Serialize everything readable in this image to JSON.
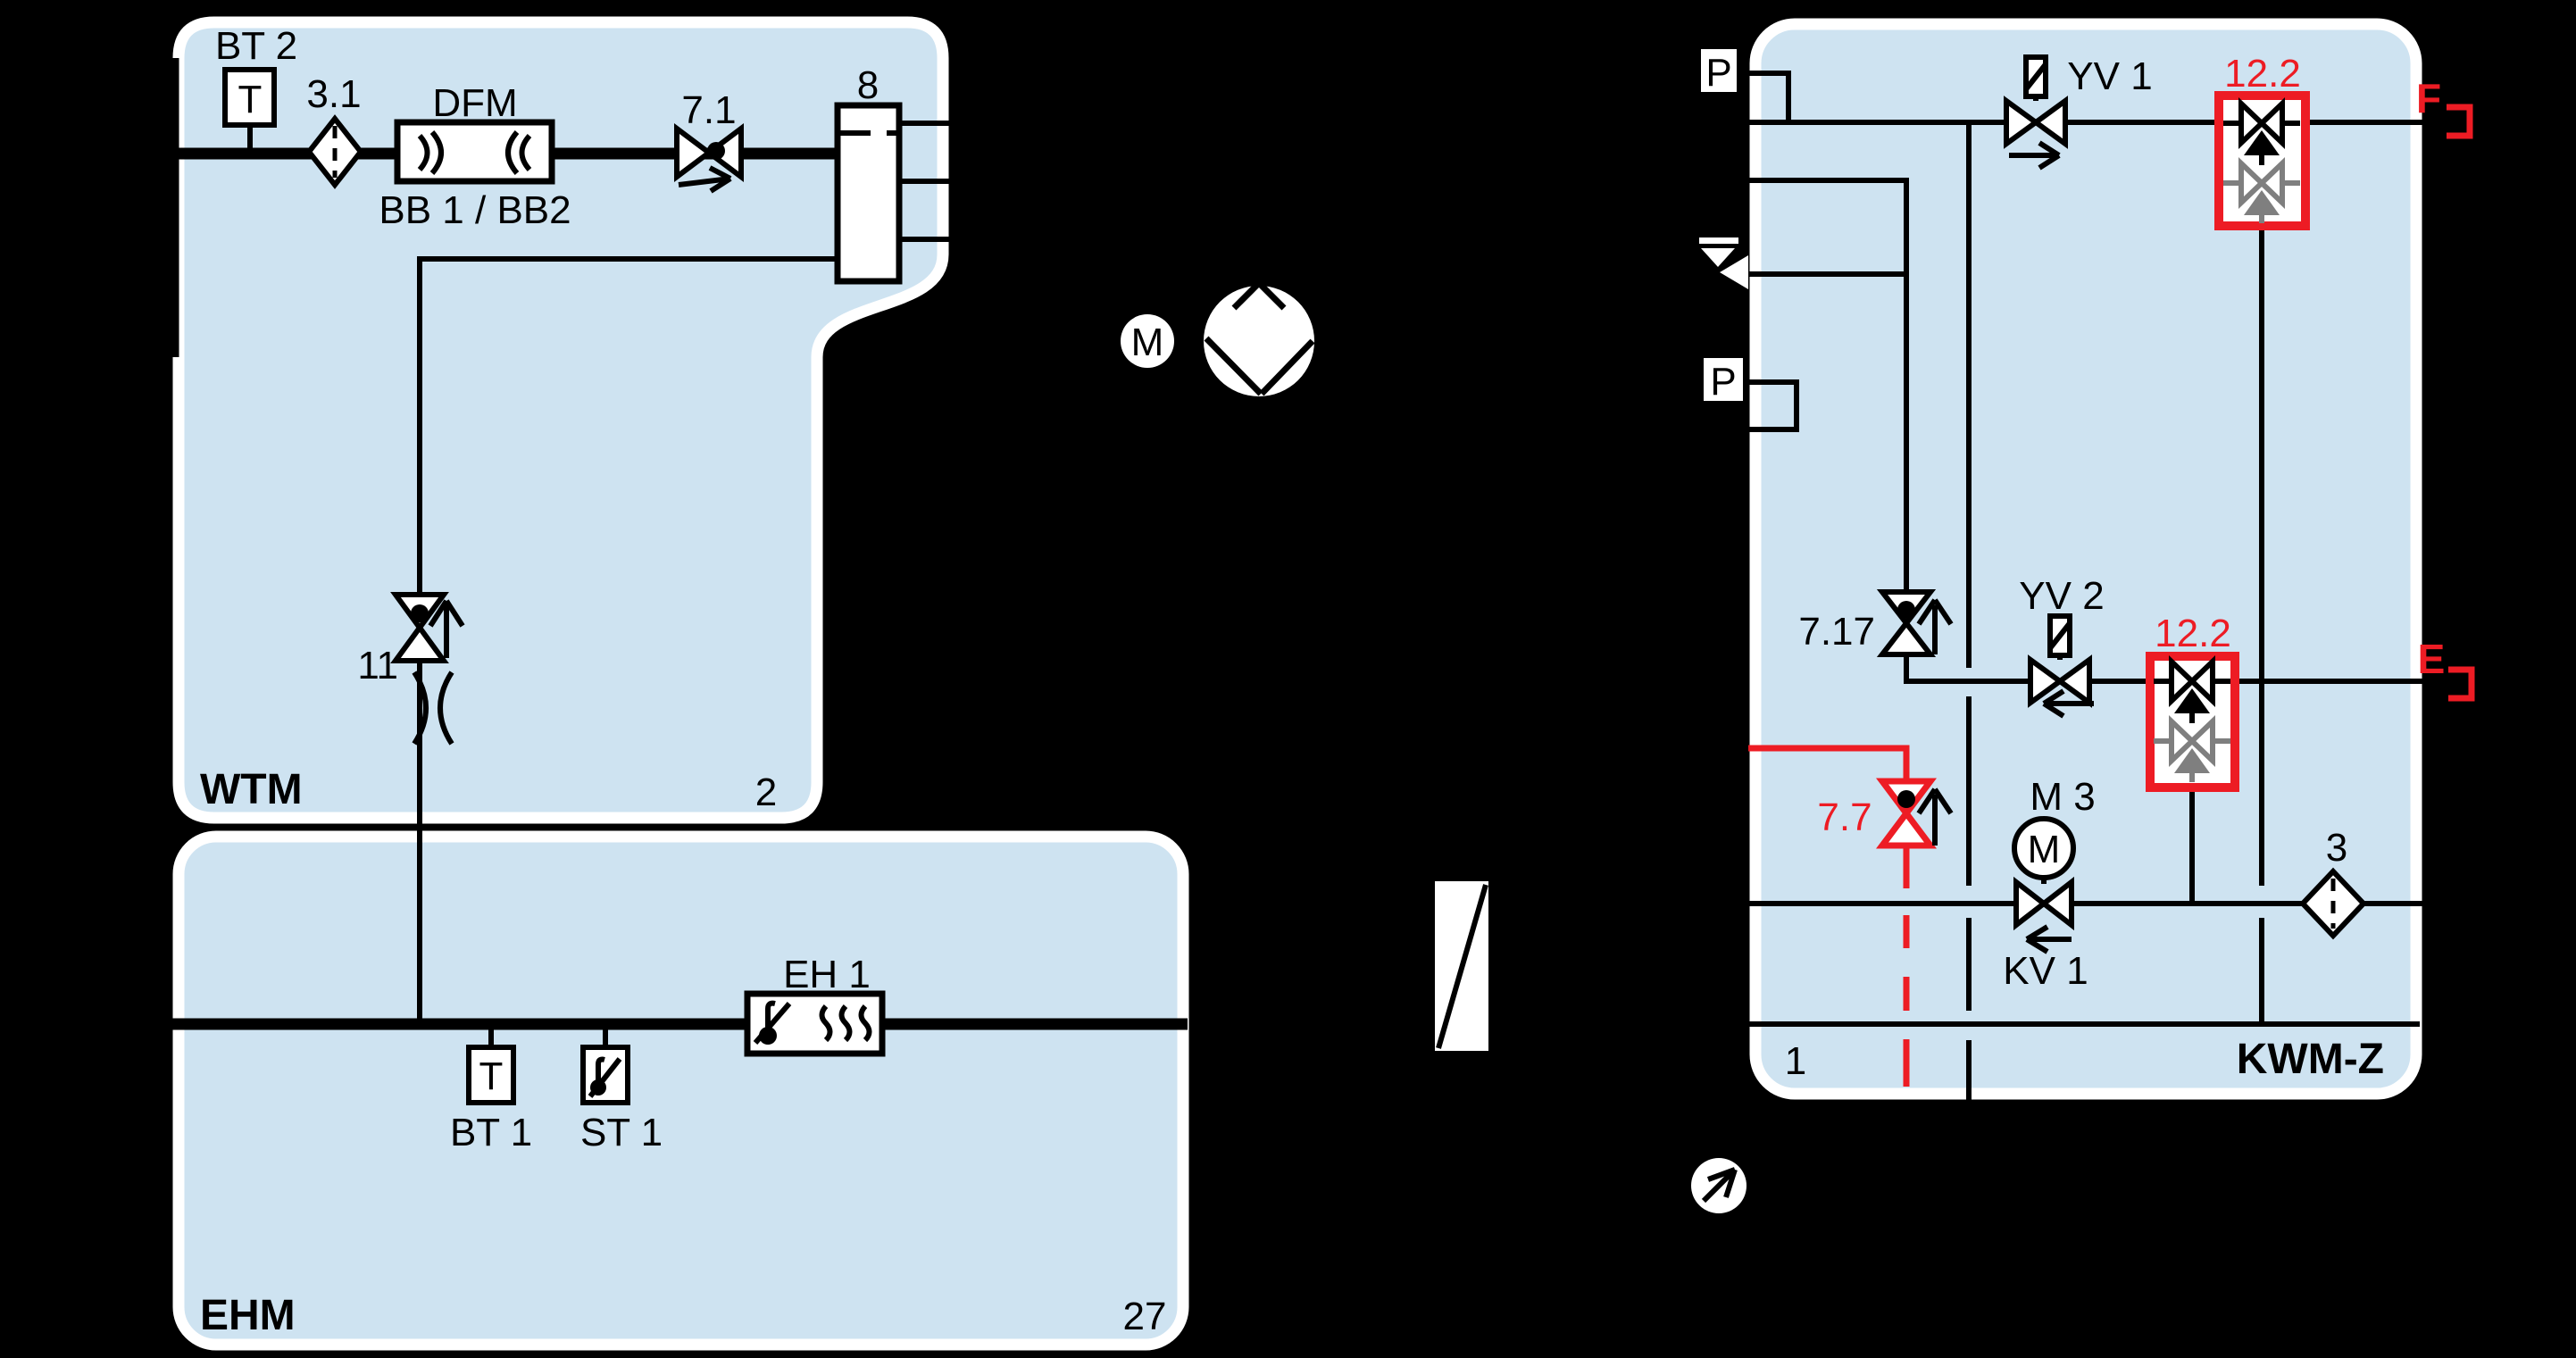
{
  "colors": {
    "background": "#000000",
    "region_fill": "#cee3f1",
    "region_border": "#ffffff",
    "line": "#000000",
    "red": "#ed1c24",
    "gray": "#7f7f7f"
  },
  "regions": {
    "wtm": {
      "label": "WTM",
      "number": "2"
    },
    "ehm": {
      "label": "EHM",
      "number": "27"
    },
    "kwm": {
      "label": "KWM-Z",
      "number": "1"
    }
  },
  "wtm": {
    "bt2": {
      "label": "BT 2",
      "letter": "T"
    },
    "strainer_31": {
      "label": "3.1"
    },
    "dfm": {
      "label": "DFM",
      "sublabel": "BB 1 / BB2"
    },
    "valve_71": {
      "label": "7.1"
    },
    "separator_8": {
      "label": "8"
    },
    "valve_11": {
      "label": "11"
    }
  },
  "pump": {
    "motor_letter": "M"
  },
  "ehm": {
    "bt1": {
      "label": "BT 1",
      "letter": "T"
    },
    "st1": {
      "label": "ST 1"
    },
    "eh1": {
      "label": "EH 1"
    }
  },
  "kwm": {
    "p_top": {
      "letter": "P"
    },
    "p_mid": {
      "letter": "P"
    },
    "yv1": {
      "label": "YV 1"
    },
    "yv2": {
      "label": "YV 2"
    },
    "valve_717": {
      "label": "7.17"
    },
    "valve_77": {
      "label": "7.7"
    },
    "backflow_top": {
      "label": "12.2"
    },
    "backflow_mid": {
      "label": "12.2"
    },
    "m3": {
      "label": "M 3",
      "letter": "M"
    },
    "kv1": {
      "label": "KV 1"
    },
    "strainer_3": {
      "label": "3"
    },
    "conn_f": {
      "label": "F"
    },
    "conn_e": {
      "label": "E"
    }
  }
}
